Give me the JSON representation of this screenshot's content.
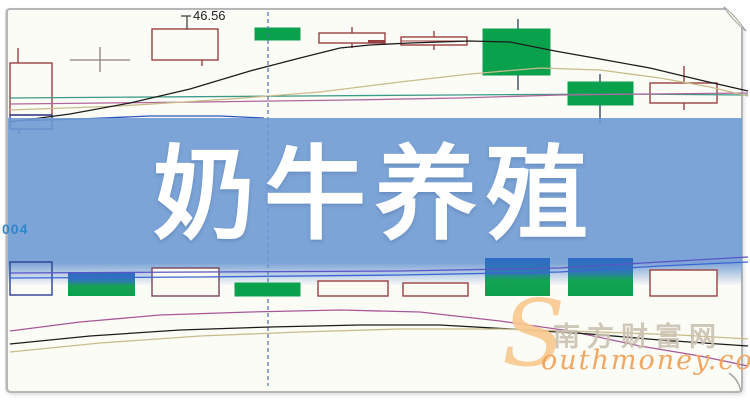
{
  "banner": {
    "title": "奶牛养殖",
    "bg": "#6e9ad2",
    "text_color": "#ffffff"
  },
  "annotations": {
    "price_label": "46.56",
    "axis_label": "004"
  },
  "watermark": {
    "initial": "S",
    "cn": "南方财富网",
    "en": "outhmoney.com",
    "orange": "#f0a35a",
    "light_orange": "#f8c88e",
    "gray": "#cbc2b1"
  },
  "chart_data": {
    "type": "candlestick",
    "title": "奶牛养殖 (dairy-cattle-farming stock theme chart)",
    "note": "No axis scale visible; only price annotation 46.56. Geometry given in screenshot pixel coordinates.",
    "price_annotation": 46.56,
    "cursor": {
      "x": 268,
      "y1": 12,
      "y2": 386,
      "color": "#4a6fa8"
    },
    "leader": {
      "color": "#333333",
      "segs": [
        [
          181,
          16,
          191,
          16
        ],
        [
          187,
          16,
          187,
          29
        ]
      ]
    },
    "panels": {
      "main": {
        "candles": [
          {
            "x": 10,
            "w": 42,
            "top": 63,
            "bot": 115,
            "kind": "hollow",
            "stroke": "#994141",
            "wickTop": {
              "x": 18,
              "y1": 48,
              "y2": 63
            }
          },
          {
            "x": 10,
            "w": 42,
            "top": 115,
            "bot": 129,
            "kind": "hollow",
            "stroke": "#2b3f94",
            "wickBot": {
              "x": 19,
              "y1": 129,
              "y2": 134
            }
          },
          {
            "x": 70,
            "w": 60,
            "top": 47,
            "bot": 72,
            "kind": "doji",
            "hy": 60,
            "stroke": "#8a8080"
          },
          {
            "x": 152,
            "w": 66,
            "top": 29,
            "bot": 60,
            "kind": "hollow",
            "stroke": "#994141",
            "wickBot": {
              "x": 202,
              "y1": 60,
              "y2": 66
            }
          },
          {
            "x": 255,
            "w": 45,
            "top": 28,
            "bot": 40,
            "kind": "solid",
            "fill": "#0aa14c"
          },
          {
            "x": 319,
            "w": 66,
            "top": 33,
            "bot": 43,
            "kind": "hollow",
            "stroke": "#994141",
            "wickTop": {
              "x": 352,
              "y1": 27,
              "y2": 33
            },
            "wickBot": {
              "x": 352,
              "y1": 43,
              "y2": 48
            },
            "inner": {
              "x": 368,
              "w": 17,
              "y": 40,
              "h": 3
            }
          },
          {
            "x": 401,
            "w": 66,
            "top": 37,
            "bot": 45,
            "kind": "hollow",
            "stroke": "#994141",
            "midline": 41,
            "wickTop": {
              "x": 434,
              "y1": 31,
              "y2": 37
            },
            "wickBot": {
              "x": 434,
              "y1": 45,
              "y2": 50
            }
          },
          {
            "x": 483,
            "w": 67,
            "top": 29,
            "bot": 75,
            "kind": "solid",
            "fill": "#0aa14c",
            "wickTop": {
              "x": 518,
              "y1": 19,
              "y2": 29
            },
            "wickBot": {
              "x": 518,
              "y1": 75,
              "y2": 90
            }
          },
          {
            "x": 568,
            "w": 65,
            "top": 82,
            "bot": 105,
            "kind": "solid",
            "fill": "#0aa14c",
            "wickTop": {
              "x": 600,
              "y1": 74,
              "y2": 82
            },
            "wickBot": {
              "x": 600,
              "y1": 105,
              "y2": 124
            }
          },
          {
            "x": 650,
            "w": 67,
            "top": 83,
            "bot": 103,
            "kind": "hollow",
            "stroke": "#994141",
            "wickTop": {
              "x": 684,
              "y1": 66,
              "y2": 83
            },
            "wickBot": {
              "x": 684,
              "y1": 103,
              "y2": 110
            }
          }
        ],
        "lines": [
          {
            "name": "ma-teal",
            "color": "#3a9a86",
            "pts": "10,98 150,97 300,96 450,95 620,94 748,95"
          },
          {
            "name": "ma-magenta",
            "color": "#b0679c",
            "pts": "10,104 200,102 350,100 460,98 560,95 650,94 748,93"
          },
          {
            "name": "ma-tan",
            "color": "#c9bc8a",
            "pts": "10,110 120,106 230,99 320,92 400,82 470,74 540,68 600,70 660,78 710,87 748,96"
          },
          {
            "name": "ma-black",
            "color": "#1c1c1c",
            "pts": "10,122 70,114 130,103 190,89 250,71 300,58 340,48 370,45 410,43 470,41 510,42 555,51 600,59 650,68 700,80 748,91"
          },
          {
            "name": "ma-blue",
            "color": "#2a52c0",
            "pts": "12,121 80,119 150,116 220,116 264,118"
          }
        ]
      },
      "lower": {
        "candles": [
          {
            "x": 10,
            "w": 42,
            "top": 262,
            "bot": 295,
            "kind": "hollow",
            "stroke": "#2b3f94"
          },
          {
            "x": 68,
            "w": 67,
            "top": 272,
            "bot": 296,
            "kind": "twotone"
          },
          {
            "x": 152,
            "w": 67,
            "top": 268,
            "bot": 296,
            "kind": "hollow",
            "stroke": "#7a4560",
            "fill": "#fbfbf4"
          },
          {
            "x": 235,
            "w": 65,
            "top": 283,
            "bot": 296,
            "kind": "solid",
            "fill": "#0aa14c"
          },
          {
            "x": 318,
            "w": 70,
            "top": 281,
            "bot": 296,
            "kind": "hollow",
            "stroke": "#994141",
            "fill": "#fbfbf4"
          },
          {
            "x": 403,
            "w": 65,
            "top": 283,
            "bot": 296,
            "kind": "hollow",
            "stroke": "#994141",
            "fill": "#fbfbf4"
          },
          {
            "x": 485,
            "w": 65,
            "top": 258,
            "bot": 296,
            "kind": "twotone"
          },
          {
            "x": 568,
            "w": 65,
            "top": 258,
            "bot": 296,
            "kind": "twotone"
          },
          {
            "x": 650,
            "w": 67,
            "top": 270,
            "bot": 296,
            "kind": "hollow",
            "stroke": "#994141",
            "fill": "#fbfbf4"
          }
        ],
        "lines": [
          {
            "name": "lower-ma-purple",
            "color": "#5b55c8",
            "pts": "10,273 200,272 400,271 560,268 660,262 748,257"
          },
          {
            "name": "lower-ma-blue",
            "color": "#3a66d4",
            "pts": "10,278 200,277 400,275 560,272 660,266 748,262"
          },
          {
            "name": "curve-magenta",
            "color": "#a85898",
            "pts": "10,331 80,322 160,315 250,312 340,310 420,312 500,321 570,331 640,346 700,356 748,366"
          },
          {
            "name": "curve-black",
            "color": "#1c1c1c",
            "pts": "10,344 90,336 180,330 270,327 360,325 440,325 510,329 590,334 660,340 748,346"
          },
          {
            "name": "curve-tan",
            "color": "#c9bc8a",
            "pts": "10,352 100,343 200,336 300,332 400,329 500,329 600,332 680,335 748,339"
          }
        ]
      }
    }
  }
}
